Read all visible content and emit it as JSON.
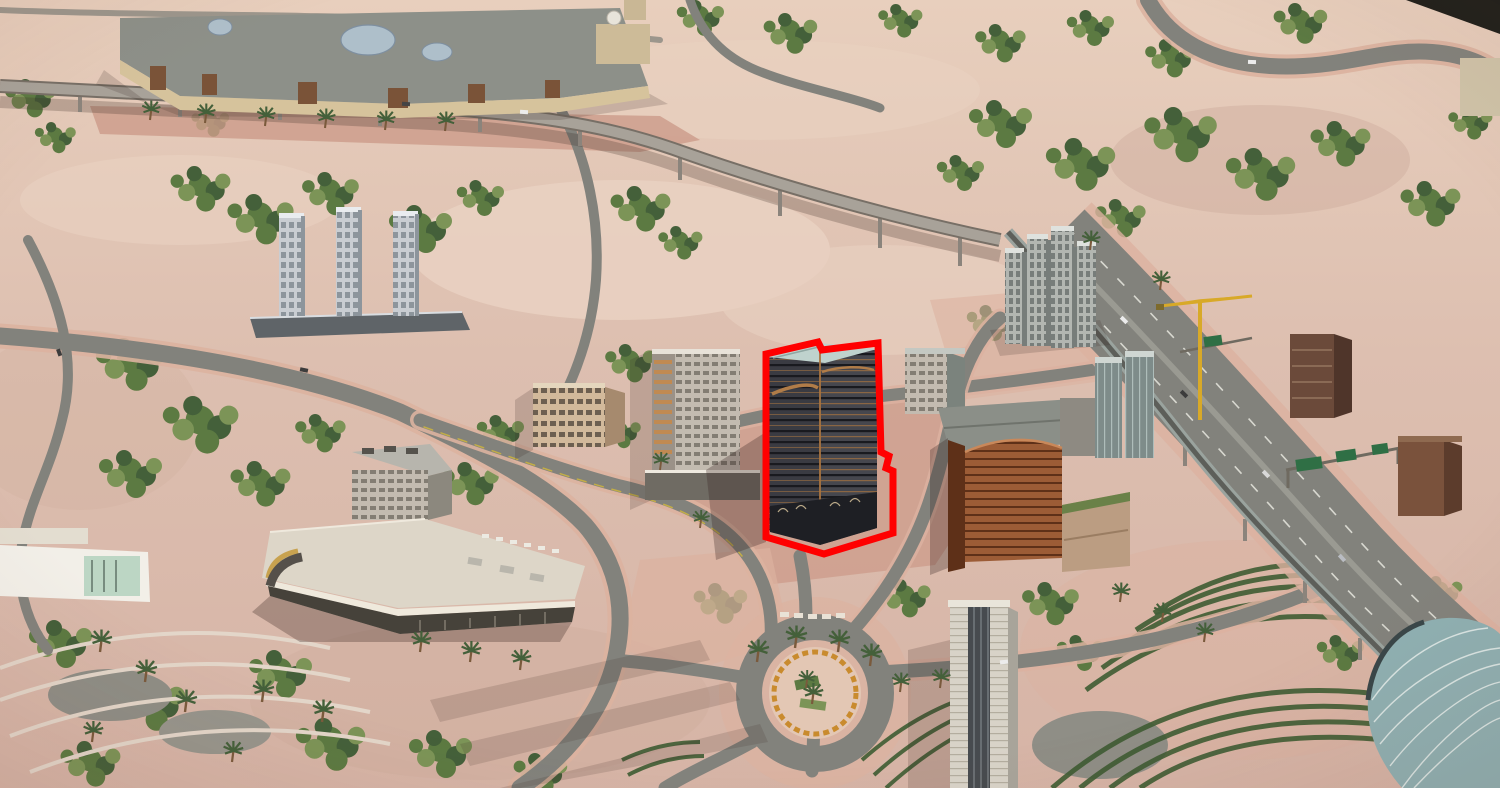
{
  "meta": {
    "type": "3d-aerial-cityscape-render",
    "description": "Photorealistic aerial render of a desert city district; a dark mid-rise tower in the center is outlined with a thick red highlight"
  },
  "highlight": {
    "color": "#ff0000",
    "stroke_width": 7,
    "target": "highlighted-tower"
  },
  "palette": {
    "sand": "#ddbfb0",
    "sandLight": "#ead3c3",
    "sandDark": "#cfae9e",
    "sandDeep": "#c49e8e",
    "road": "#82827c",
    "roadLight": "#9c968c",
    "roadDark": "#63635d",
    "deck": "#a8a299",
    "sidewalk": "#cc9b89",
    "sidewalkLight": "#dcb2a0",
    "green": "#5c7a42",
    "greenDark": "#44603a",
    "greenLight": "#7c9457",
    "hedge": "#3f5c33",
    "mallWall": "#d6c39c",
    "mallWallDark": "#a98e68",
    "mallRoof": "#8d9089",
    "dome": "#aebfca",
    "towerLight": "#c9cdd2",
    "towerFace": "#8d959c",
    "podium": "#5f6468",
    "clusterA": "#b2b6b1",
    "clusterB": "#777d7a",
    "highlight": "#ff0000",
    "hlFacade": "#3a3b42",
    "hlFacade2": "#46474e",
    "hlLine": "#191a1f",
    "hlBronze": "#a9743f",
    "hlRoof": "#bfd2cd",
    "hlGlass": "#1e1f24",
    "arenaRoof": "#ddd6c8",
    "arenaGold": "#c8a24f",
    "arenaGlass": "#55504a",
    "arenaWall": "#efe9dc",
    "arenaArcade": "#46423a",
    "orange": "#9c5c36",
    "orangeDark": "#5e3018",
    "podBeige": "#bb9d82",
    "greenRoof": "#6a8148",
    "beige": "#d2b99b",
    "beigeDark": "#a68a6e",
    "gray": "#9aa098",
    "grayDark": "#7b837d",
    "metroGlass": "#8fb0b2",
    "metroRib": "#e6efec",
    "track": "#9aa39e",
    "crane": "#d8a928",
    "sign": "#2f6f45",
    "white": "#f2efe8",
    "tan": "#c3bbb0"
  },
  "landmarks": [
    {
      "id": "mall-complex",
      "label": "mall with glass domes"
    },
    {
      "id": "elevated-guideway",
      "label": "elevated roadway on columns"
    },
    {
      "id": "triple-towers",
      "label": "three residential towers on podium"
    },
    {
      "id": "tower-cluster",
      "label": "high-rise cluster"
    },
    {
      "id": "highlighted-tower",
      "label": "dark tower outlined in red"
    },
    {
      "id": "arena",
      "label": "white-roof arena with gold band"
    },
    {
      "id": "orange-building",
      "label": "copper louvered building"
    },
    {
      "id": "roundabout",
      "label": "landscaped roundabout with palms"
    },
    {
      "id": "highway",
      "label": "divided highway with sign gantries"
    },
    {
      "id": "metro-track",
      "label": "elevated metro track"
    },
    {
      "id": "metro-station",
      "label": "curved glass metro station"
    },
    {
      "id": "terraced-gardens",
      "label": "concentric hedge terraces"
    },
    {
      "id": "construction-crane",
      "label": "tower crane"
    },
    {
      "id": "tall-tower-south",
      "label": "light tower at south"
    }
  ]
}
